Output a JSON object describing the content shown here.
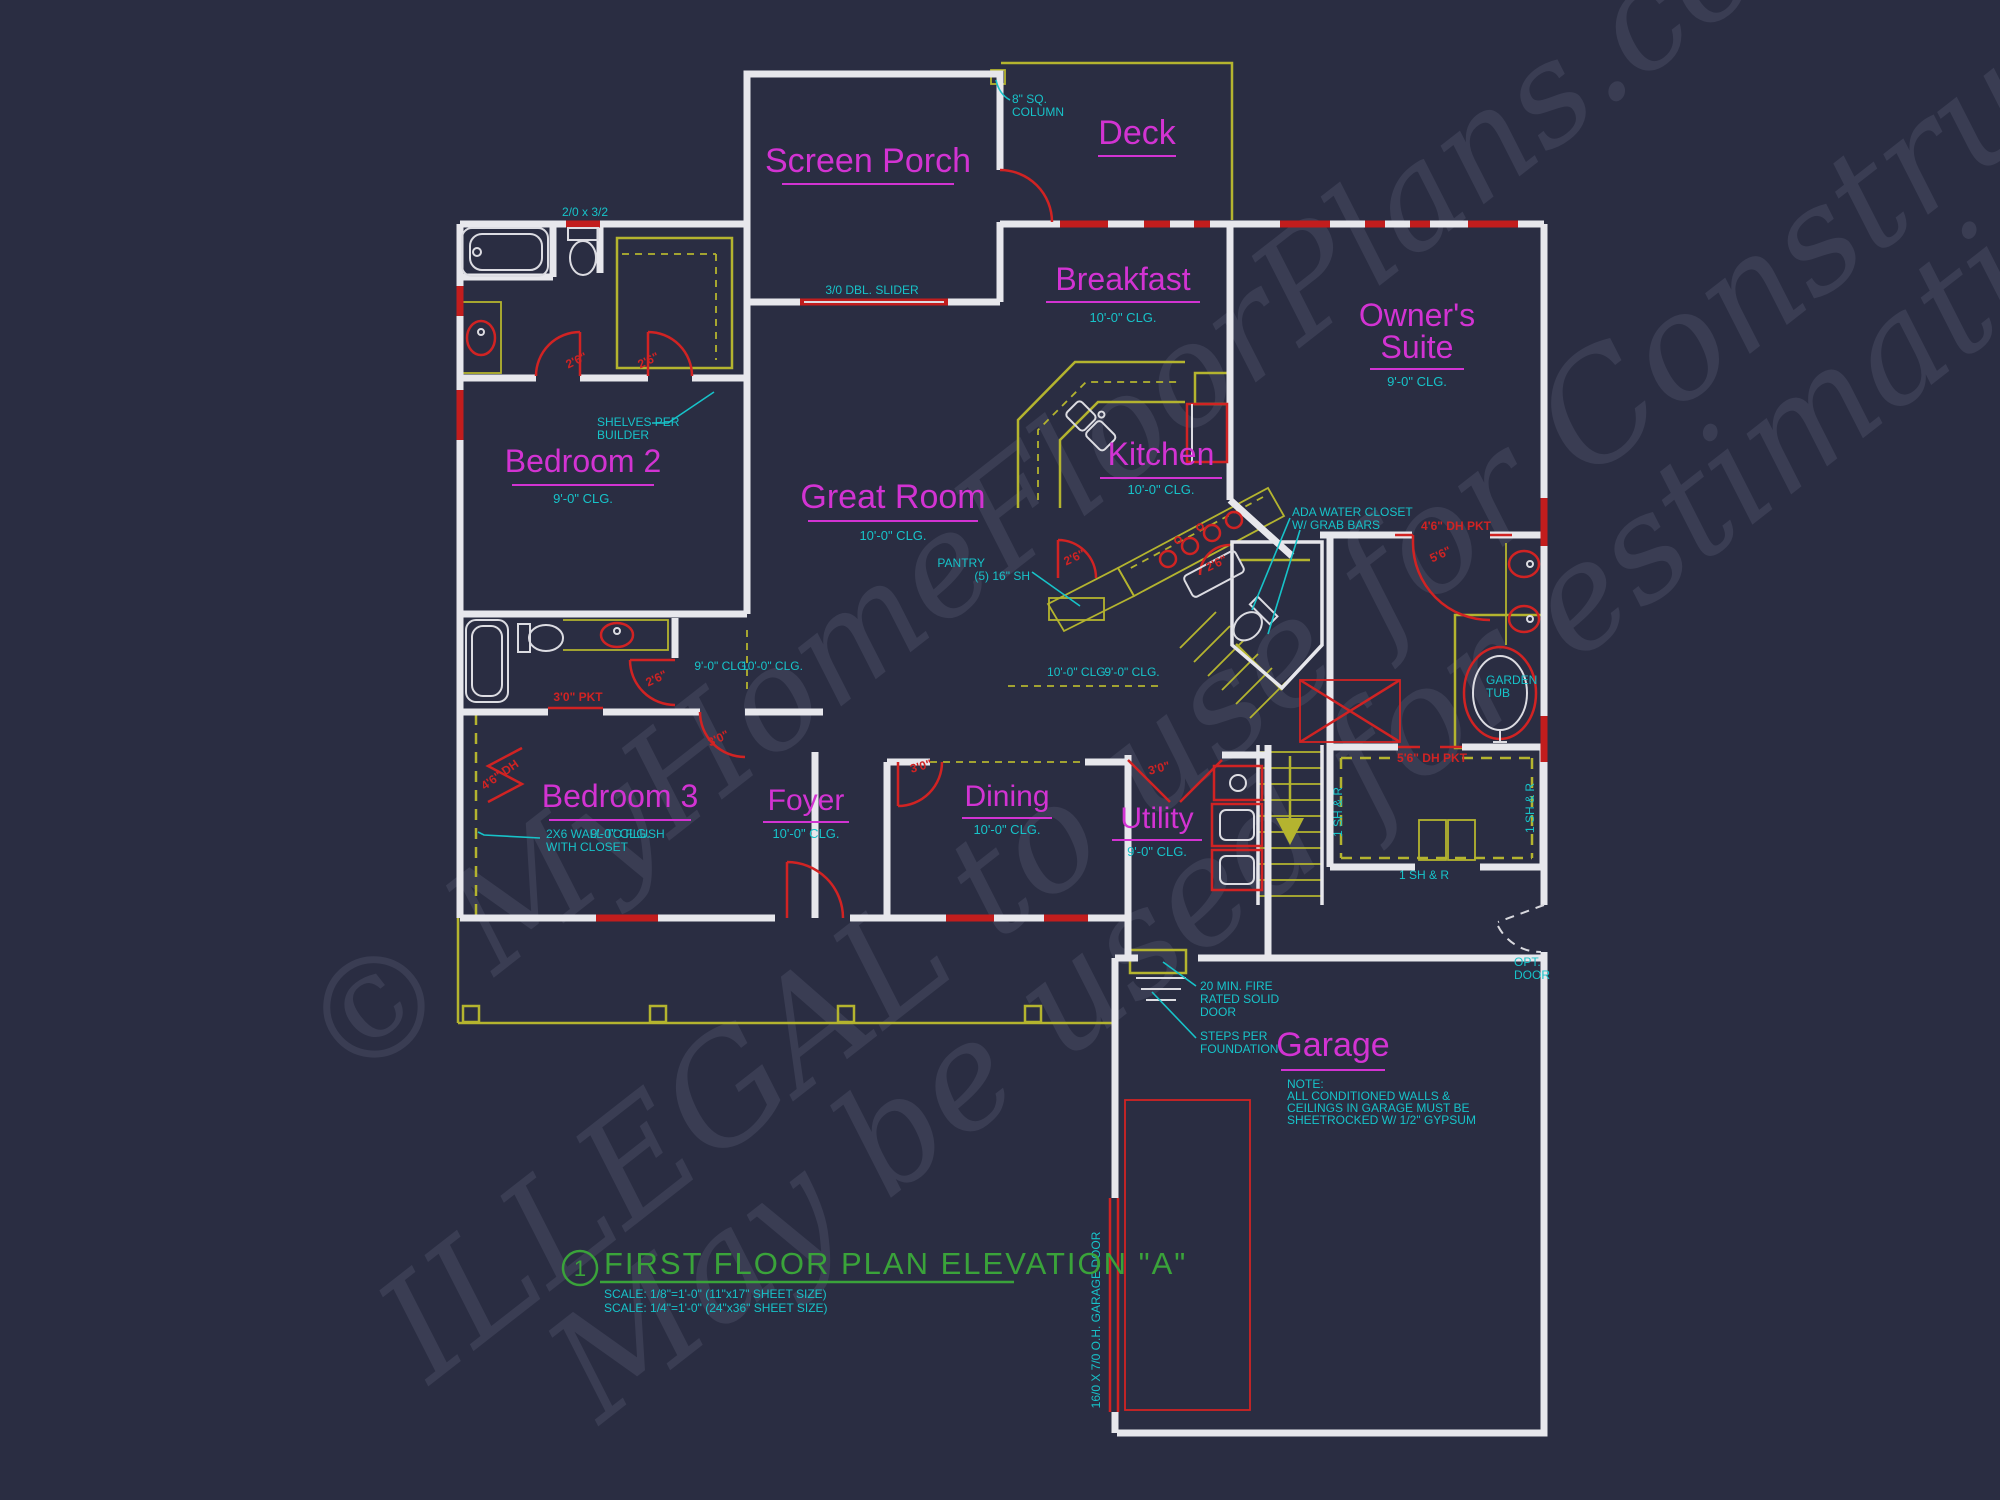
{
  "colors": {
    "background": "#2a2d42",
    "walls": "#e7e7ec",
    "room_labels": "#d233d2",
    "annotations": "#17c3c9",
    "doors_windows": "#d12323",
    "cad_yellow": "#b4b42f",
    "title_green": "#3aa33a",
    "watermark": "#b9c0dd"
  },
  "watermark": {
    "line1": "© MyHomeFloorPlans.com",
    "line2": "ILLEGAL to use for Construction",
    "line3": "May be used for estimations"
  },
  "rooms": {
    "screen_porch": {
      "name": "Screen Porch"
    },
    "deck": {
      "name": "Deck"
    },
    "breakfast": {
      "name": "Breakfast",
      "ceiling": "10'-0\" CLG."
    },
    "owners_suite": {
      "name_line1": "Owner's",
      "name_line2": "Suite",
      "ceiling": "9'-0\" CLG."
    },
    "great_room": {
      "name": "Great Room",
      "ceiling": "10'-0\" CLG."
    },
    "kitchen": {
      "name": "Kitchen",
      "ceiling": "10'-0\" CLG."
    },
    "bedroom2": {
      "name": "Bedroom 2",
      "ceiling": "9'-0\" CLG."
    },
    "bedroom3": {
      "name": "Bedroom 3",
      "ceiling": "9'-0\" CLG."
    },
    "foyer": {
      "name": "Foyer",
      "ceiling": "10'-0\" CLG."
    },
    "dining": {
      "name": "Dining",
      "ceiling": "10'-0\" CLG."
    },
    "utility": {
      "name": "Utility",
      "ceiling": "9'-0\" CLG."
    },
    "garage": {
      "name": "Garage"
    }
  },
  "annotations": {
    "column": {
      "line1": "8\" SQ.",
      "line2": "COLUMN"
    },
    "slider": "3/0 DBL. SLIDER",
    "window_size": "2/0 x 3/2",
    "shelves": {
      "line1": "SHELVES PER",
      "line2": "BUILDER"
    },
    "pantry": {
      "line1": "PANTRY",
      "line2": "(5) 16\" SH"
    },
    "ada": {
      "line1": "ADA WATER CLOSET",
      "line2": "W/ GRAB BARS"
    },
    "garden_tub": {
      "line1": "GARDEN",
      "line2": "TUB"
    },
    "wall_note": {
      "line1": "2X6 WALL TO FLUSH",
      "line2": "WITH CLOSET"
    },
    "fire_door": {
      "line1": "20 MIN. FIRE",
      "line2": "RATED SOLID",
      "line3": "DOOR"
    },
    "steps": {
      "line1": "STEPS PER",
      "line2": "FOUNDATION"
    },
    "garage_note": {
      "line1": "NOTE:",
      "line2": "ALL CONDITIONED WALLS &",
      "line3": "CEILINGS IN GARAGE MUST BE",
      "line4": "SHEETROCKED W/ 1/2\" GYPSUM"
    },
    "opt_door": {
      "line1": "OPT.",
      "line2": "DOOR"
    },
    "garage_door": "16/0 X 7/0 O.H. GARAGE DOOR",
    "clg9": "9'-0\" CLG.",
    "clg10": "10'-0\" CLG.",
    "closet_shelf": "1 SH & R"
  },
  "door_labels": {
    "d26": "2'6\"",
    "d30": "3'0\"",
    "d30pkt": "3'0\" PKT",
    "d46dh": "4'6\" DH",
    "d46dhpkt": "4'6\" DH PKT",
    "d56": "5'6\"",
    "d56dhpkt": "5'6\" DH PKT"
  },
  "title": {
    "number": "1",
    "text": "FIRST FLOOR PLAN ELEVATION \"A\"",
    "scale1": "SCALE: 1/8\"=1'-0\" (11\"x17\" SHEET SIZE)",
    "scale2": "SCALE: 1/4\"=1'-0\" (24\"x36\" SHEET SIZE)"
  }
}
